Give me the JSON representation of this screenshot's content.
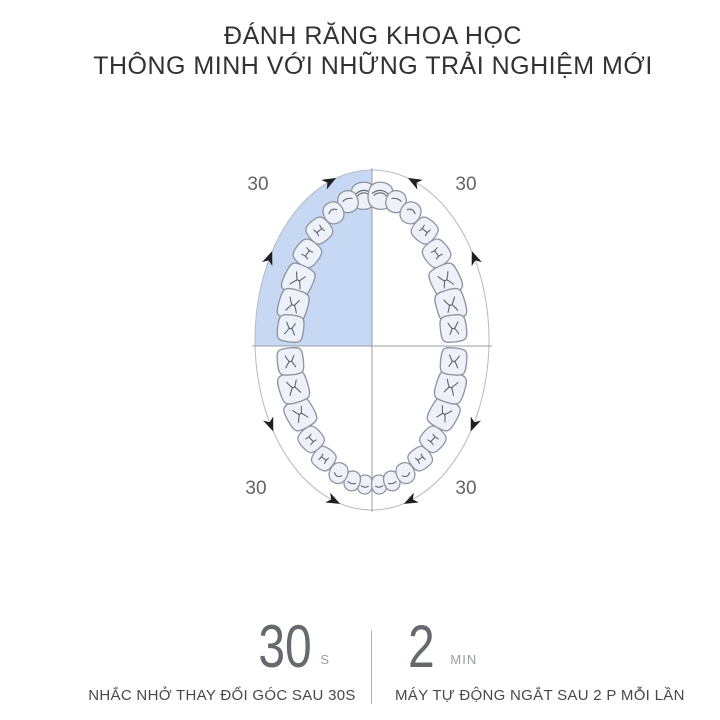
{
  "title": {
    "line1": "ĐÁNH RĂNG KHOA HỌC",
    "line2": "THÔNG MINH VỚI NHỮNG TRẢI NGHIỆM MỚI"
  },
  "diagram": {
    "corner_labels": {
      "top_left": "30",
      "top_right": "30",
      "bottom_left": "30",
      "bottom_right": "30"
    },
    "highlighted_quadrant": "upper-left",
    "teeth_count": 32
  },
  "stats": {
    "left": {
      "value": "30",
      "unit": "S",
      "caption": "NHẮC NHỞ THAY ĐỔI GÓC SAU 30S"
    },
    "right": {
      "value": "2",
      "unit": "MIN",
      "caption": "MÁY TỰ ĐỘNG NGẮT SAU 2 P MỖI LẦN"
    }
  },
  "colors": {
    "highlight_blue": "#c6d8f3",
    "tooth_fill": "#edf1f9",
    "tooth_outline": "#8e95a1",
    "fissure": "#5f6670",
    "ellipse_line": "#b6bac0",
    "crosshair_line": "#9b9ea3",
    "arrow": "#202022",
    "corner_label": "#646466",
    "stat_number": "#66696d",
    "stat_unit": "#9a9da1",
    "caption_text": "#48484a",
    "title_text": "#323234",
    "divider": "#b3b3b5"
  }
}
